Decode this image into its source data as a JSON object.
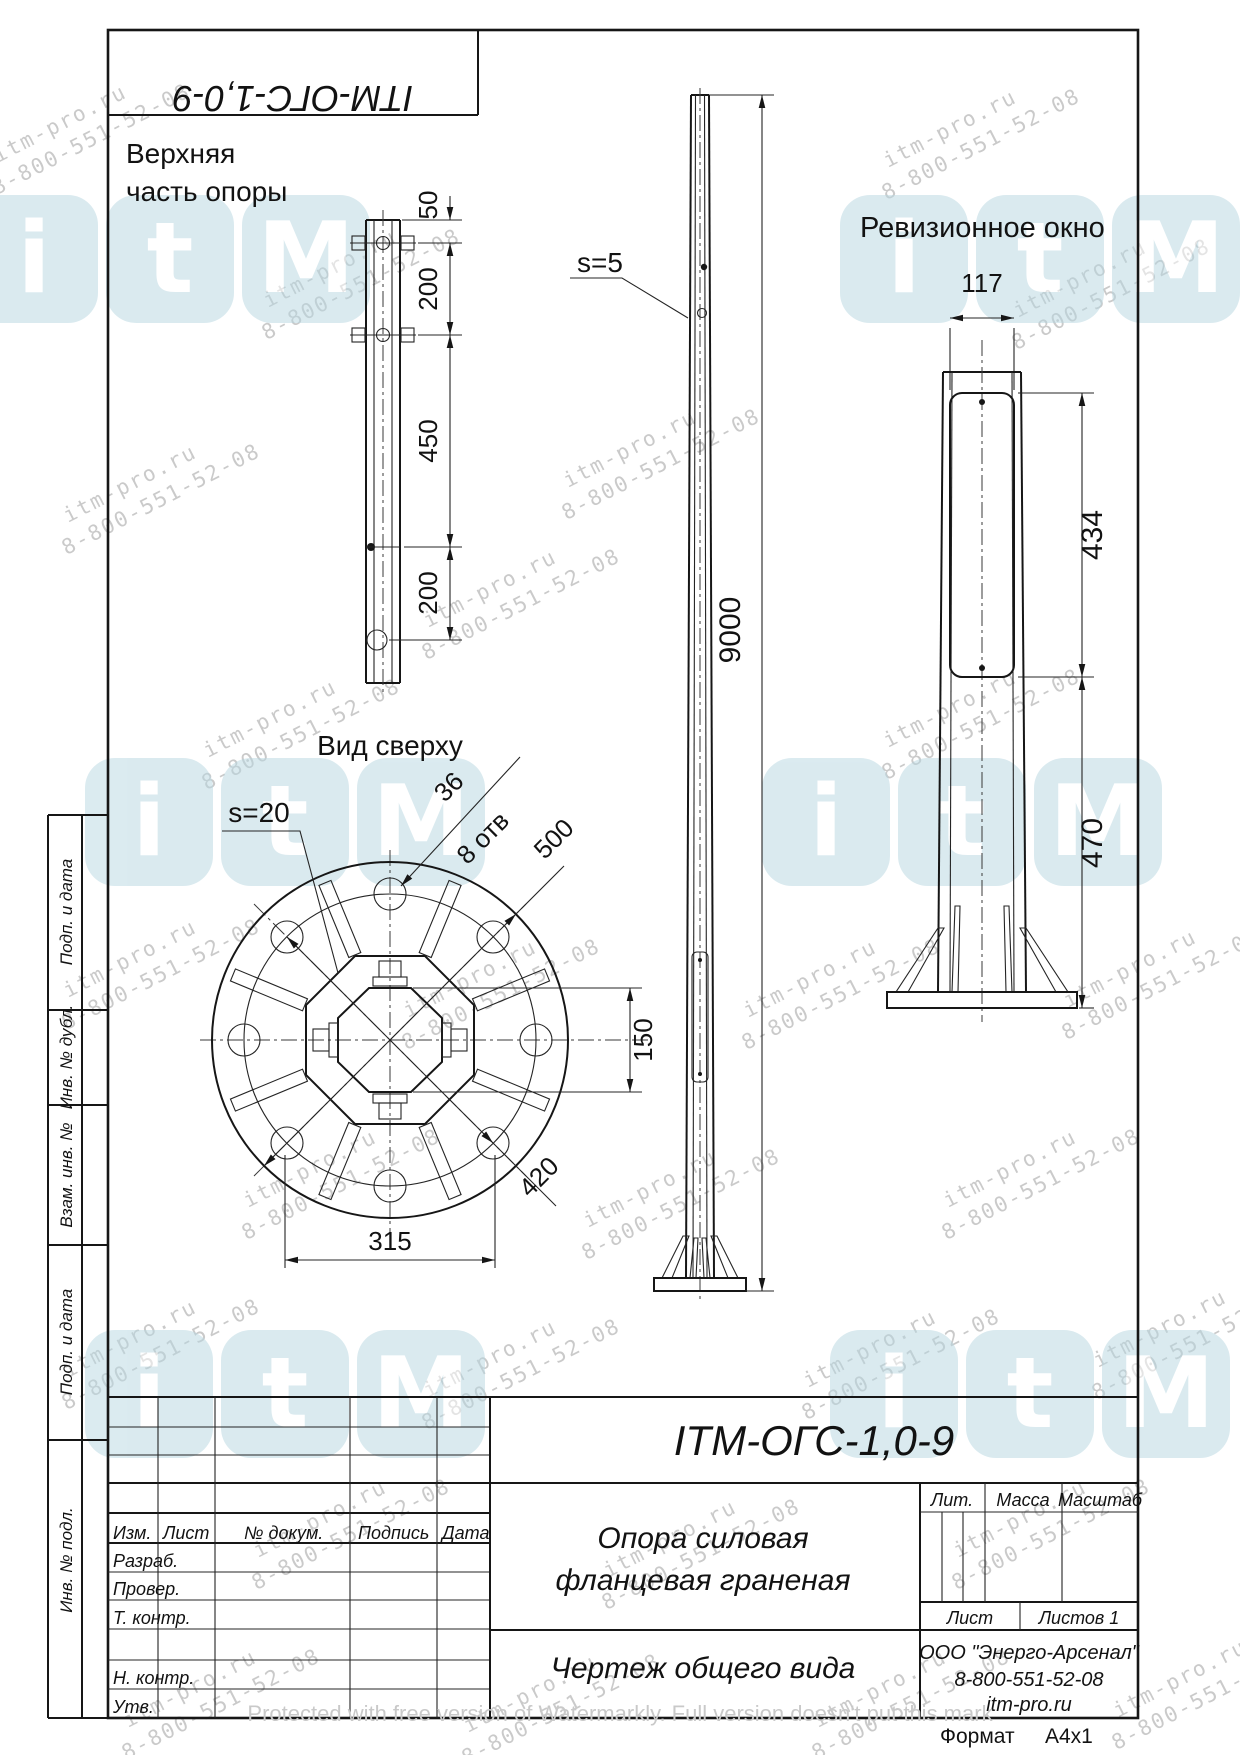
{
  "page": {
    "format_label": "Формат",
    "format_value": "А4х1",
    "protection_watermark": "Protected with free version of Watermarkly. Full version doesn't put this mark"
  },
  "corner_stamp": {
    "designation": "ITM-ОГС-1,0-9"
  },
  "views": {
    "upper_detail": {
      "title1": "Верхняя",
      "title2": "часть опоры",
      "dim_50": "50",
      "dim_200a": "200",
      "dim_450": "450",
      "dim_200b": "200"
    },
    "elevation": {
      "wall_label": "s=5",
      "dim_height": "9000"
    },
    "revision": {
      "title": "Ревизионное окно",
      "dim_width": "117",
      "dim_window": "434",
      "dim_bottom": "470"
    },
    "top": {
      "title": "Вид сверху",
      "wall_label": "s=20",
      "dim_hole": "36",
      "holes_note": "8 отв",
      "dim_outer": "500",
      "dim_bolt_circle": "420",
      "dim_flats": "315",
      "dim_inner": "150"
    }
  },
  "title_block": {
    "designation": "ITM-ОГС-1,0-9",
    "name1": "Опора силовая",
    "name2": "фланцевая граненая",
    "doc_type": "Чертеж общего вида",
    "company": "ООО \"Энерго-Арсенал\"",
    "phone": "8-800-551-52-08",
    "site": "itm-pro.ru",
    "col_izm": "Изм.",
    "col_list": "Лист",
    "col_doc": "№ докум.",
    "col_sign": "Подпись",
    "col_date": "Дата",
    "row_razrab": "Разраб.",
    "row_prover": "Провер.",
    "row_tkontr": "Т. контр.",
    "row_nkontr": "Н. контр.",
    "row_utv": "Утв.",
    "lit": "Лит.",
    "massa": "Масса",
    "masshtab": "Масштаб",
    "list": "Лист",
    "listov": "Листов 1"
  },
  "sidebar": {
    "cells": [
      "Подп. и дата",
      "Инв. № дубл.",
      "Взам. инв. №",
      "Подп. и дата",
      "Инв. № подл."
    ]
  },
  "watermark": {
    "line1": "itm-pro.ru",
    "line2": "8-800-551-52-08",
    "text_color": "#bdbdbd",
    "logo_color": "#b7d7e1",
    "logo_letters": [
      "i",
      "t",
      "M"
    ],
    "logo_positions": [
      [
        -30,
        195
      ],
      [
        840,
        195
      ],
      [
        85,
        758
      ],
      [
        762,
        758
      ],
      [
        85,
        1330
      ],
      [
        830,
        1330
      ]
    ],
    "text_positions": [
      [
        -10,
        95
      ],
      [
        880,
        100
      ],
      [
        260,
        240
      ],
      [
        1010,
        250
      ],
      [
        60,
        455
      ],
      [
        560,
        420
      ],
      [
        420,
        560
      ],
      [
        880,
        680
      ],
      [
        200,
        690
      ],
      [
        60,
        930
      ],
      [
        400,
        950
      ],
      [
        740,
        950
      ],
      [
        1060,
        940
      ],
      [
        240,
        1140
      ],
      [
        580,
        1160
      ],
      [
        940,
        1140
      ],
      [
        60,
        1310
      ],
      [
        420,
        1330
      ],
      [
        800,
        1320
      ],
      [
        1090,
        1300
      ],
      [
        250,
        1490
      ],
      [
        600,
        1510
      ],
      [
        950,
        1490
      ],
      [
        120,
        1660
      ],
      [
        460,
        1665
      ],
      [
        810,
        1660
      ],
      [
        1110,
        1650
      ]
    ]
  }
}
